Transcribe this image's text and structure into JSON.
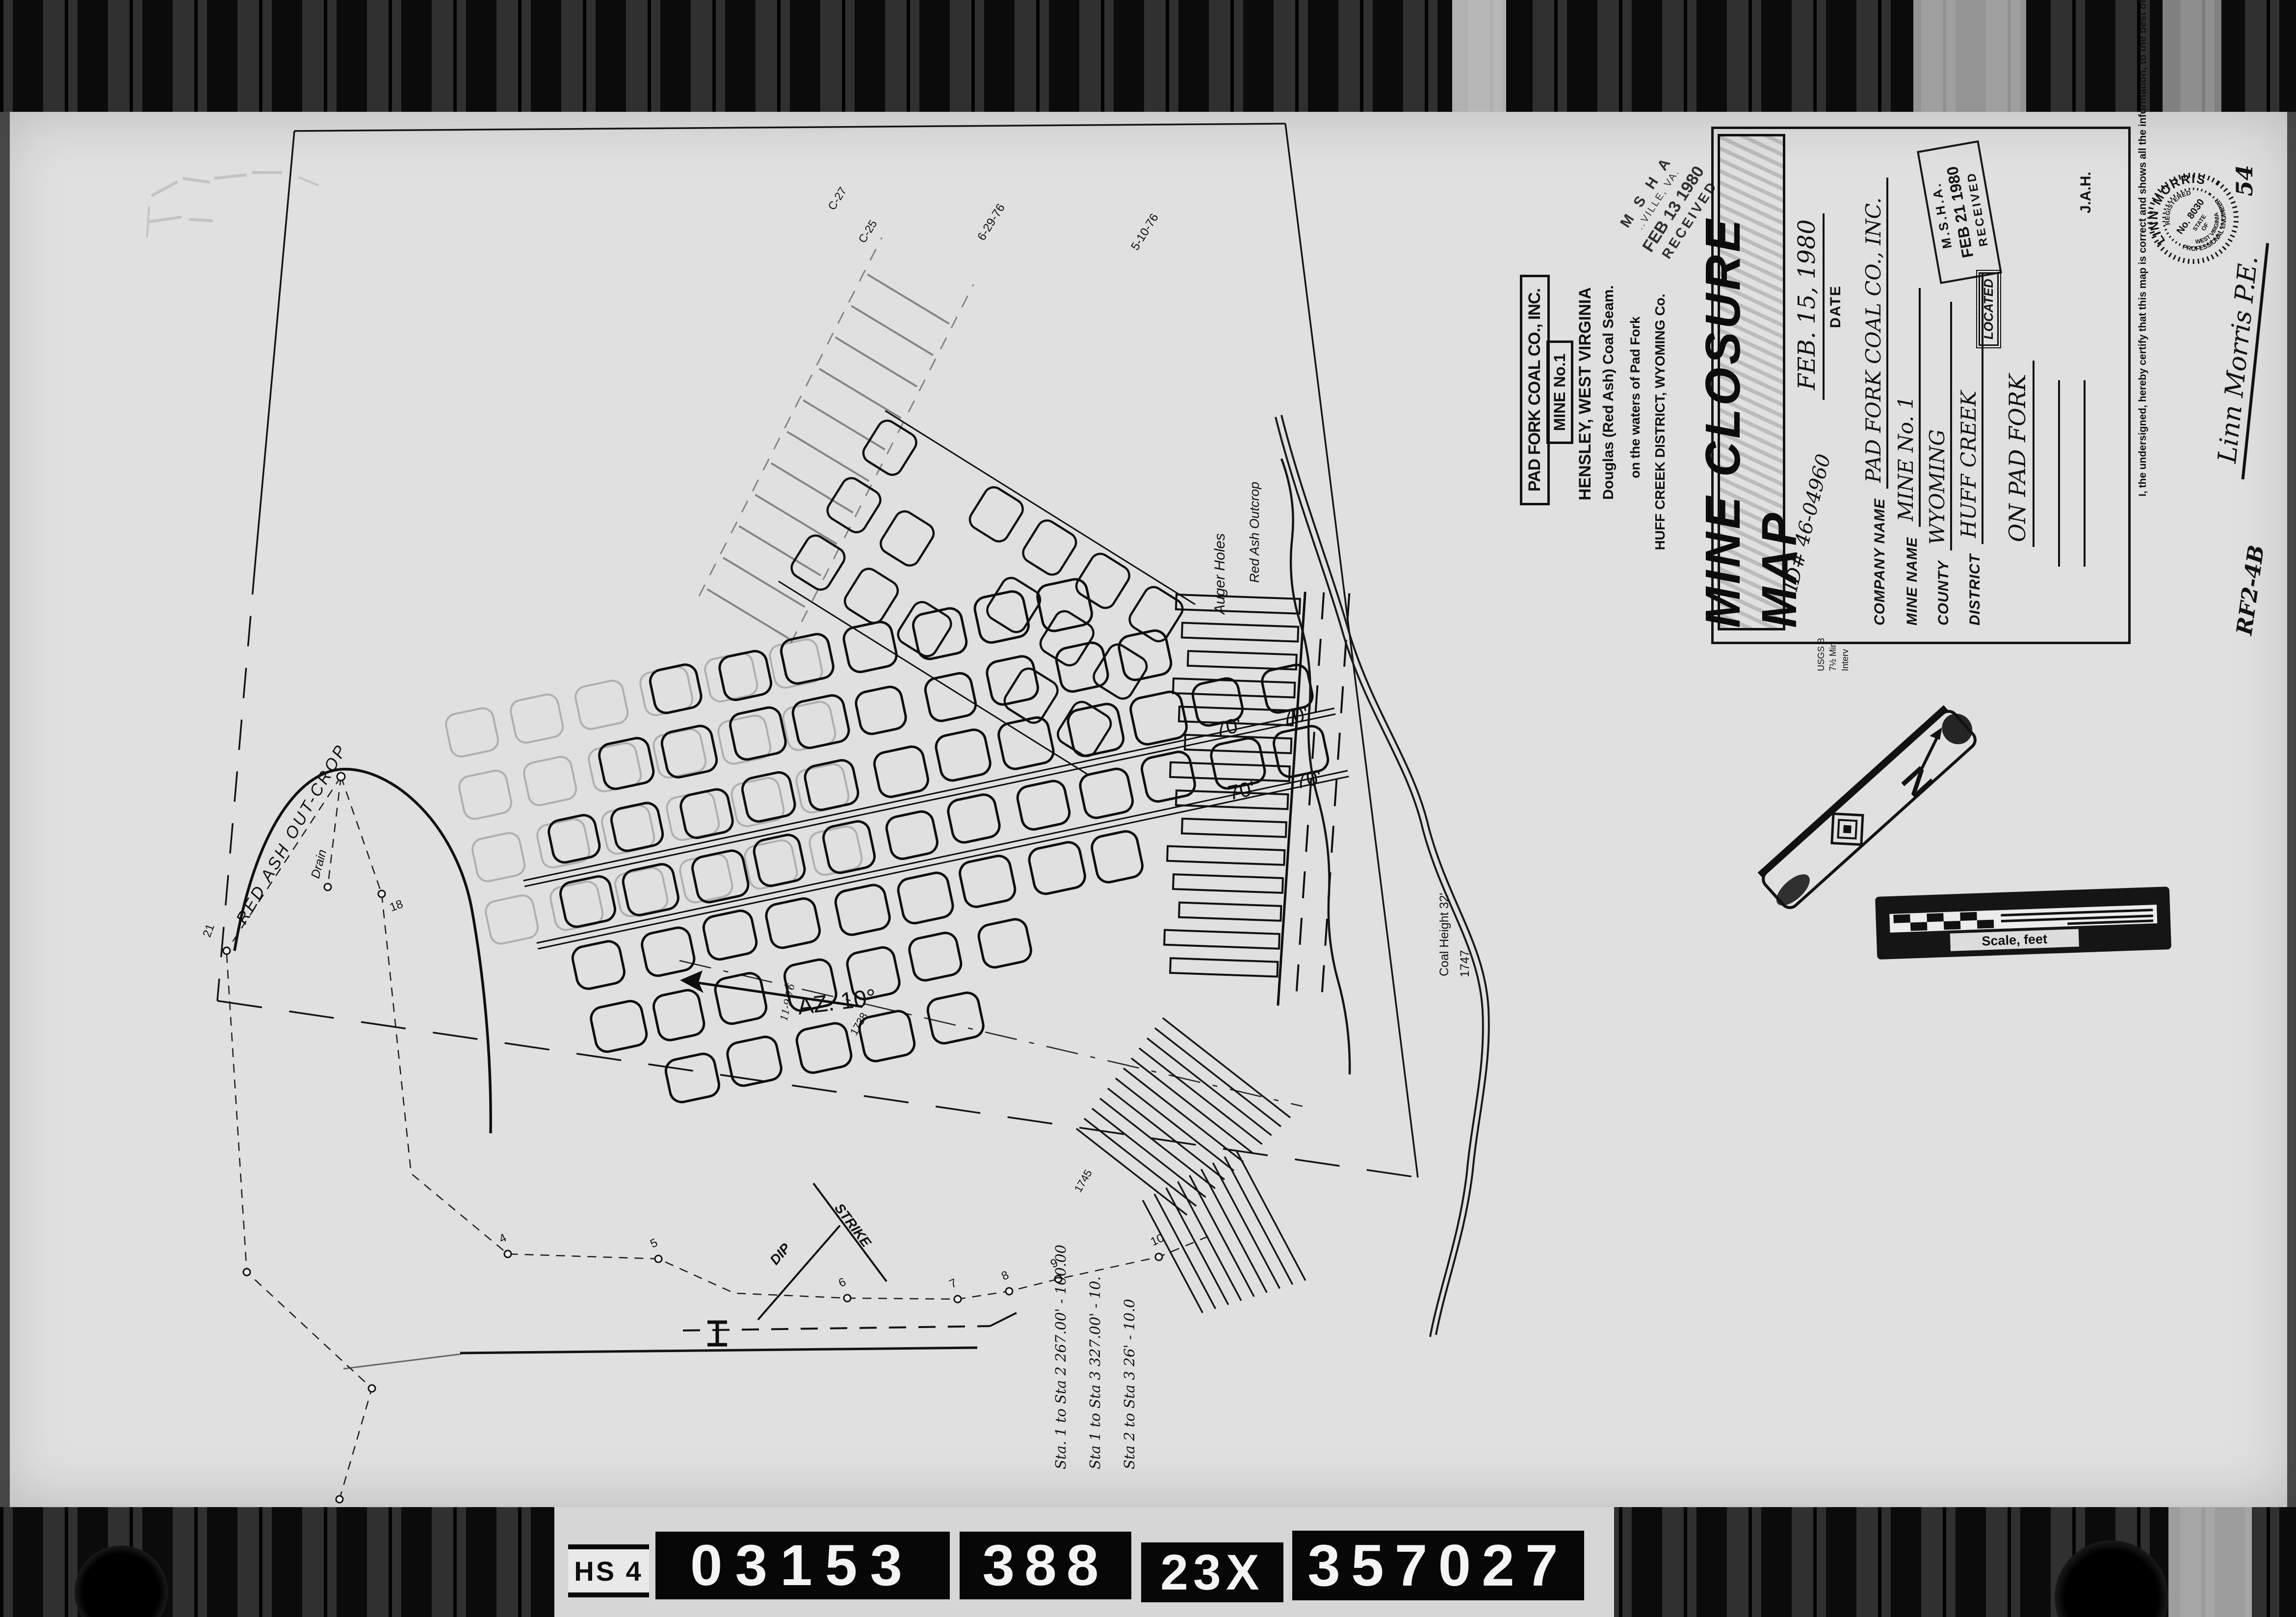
{
  "film": {
    "hs_label": "HS 4",
    "frames": [
      "03153",
      "388",
      "23X",
      "357027"
    ]
  },
  "map": {
    "az_label": "AZ. 10°",
    "az_date": "11-9-76",
    "survey_dates": [
      "6-29-76",
      "5-10-76"
    ],
    "pillar_width_label": "70'",
    "outcrop_label": "RED ASH OUT-CROP",
    "auger_label": "Auger Holes",
    "outcrop_label_2": "Red Ash Outcrop",
    "drain_label": "Drain",
    "dip_label": "DIP",
    "strike_label": "STRIKE",
    "coal_height_label": "Coal Height 32'",
    "elevation_labels": [
      "C-25",
      "C-27",
      "1738",
      "1745",
      "1747"
    ],
    "station_numbers": [
      "4",
      "5",
      "6",
      "7",
      "8",
      "9",
      "10"
    ],
    "outcrop_station_numbers": [
      "18",
      "21"
    ],
    "station_notes": [
      "Sta. 1 to Sta 2   267.00' - 100.00",
      "Sta 1 to Sta 3   327.00' - 10.",
      "Sta 2 to Sta 3   26' - 10.0"
    ]
  },
  "company_block": {
    "company": "PAD FORK COAL CO., INC.",
    "mine": "MINE No.1",
    "location": "HENSLEY,  WEST VIRGINIA",
    "seam": "Douglas (Red Ash) Coal Seam.",
    "waters": "on the waters of Pad Fork",
    "district": "HUFF CREEK DISTRICT, WYOMING Co."
  },
  "title_block": {
    "title": "MINE CLOSURE MAP",
    "date_value": "FEB. 15, 1980",
    "date_label": "DATE",
    "id_note": "ID# 46-04960",
    "fields": [
      {
        "label": "COMPANY NAME",
        "value": "PAD FORK COAL CO., INC."
      },
      {
        "label": "MINE NAME",
        "value": "MINE No. 1"
      },
      {
        "label": "COUNTY",
        "value": "WYOMING"
      },
      {
        "label": "DISTRICT",
        "value": "HUFF CREEK"
      }
    ],
    "located_label": "LOCATED",
    "located_value": "ON PAD FORK",
    "initials": "J.A.H.",
    "usgs_note": [
      "USGS B",
      "7½ Min",
      "Interv"
    ],
    "ref_code": "RF2-4B",
    "page_number": "54"
  },
  "stamps": {
    "msha_top": {
      "agency": "M S H A",
      "office": "..VILLE, VA.",
      "date": "FEB 13 1980",
      "status": "RECEIVED"
    },
    "msha_title": {
      "agency": "M.S.H.A.",
      "date": "FEB 21 1980",
      "status": "RECEIVED"
    }
  },
  "seal": {
    "name": "LINN MORRIS",
    "registered": "REGISTERED",
    "number": "No. 8030",
    "state_line1": "STATE",
    "state_line2": "OF",
    "state_line3": "WEST VIRGINIA",
    "profession": "PROFESSIONAL ENGINEER"
  },
  "certification": {
    "text": "I, the undersigned, hereby certify that this map is correct and shows all the information, to the best of my knowledge and belief, requiring by the laws of this state, and covers the period ending",
    "signature": "Linn Morris P.E."
  },
  "scale_bar": {
    "label": "Scale, feet"
  },
  "north_arrow": {
    "letter": "N"
  }
}
